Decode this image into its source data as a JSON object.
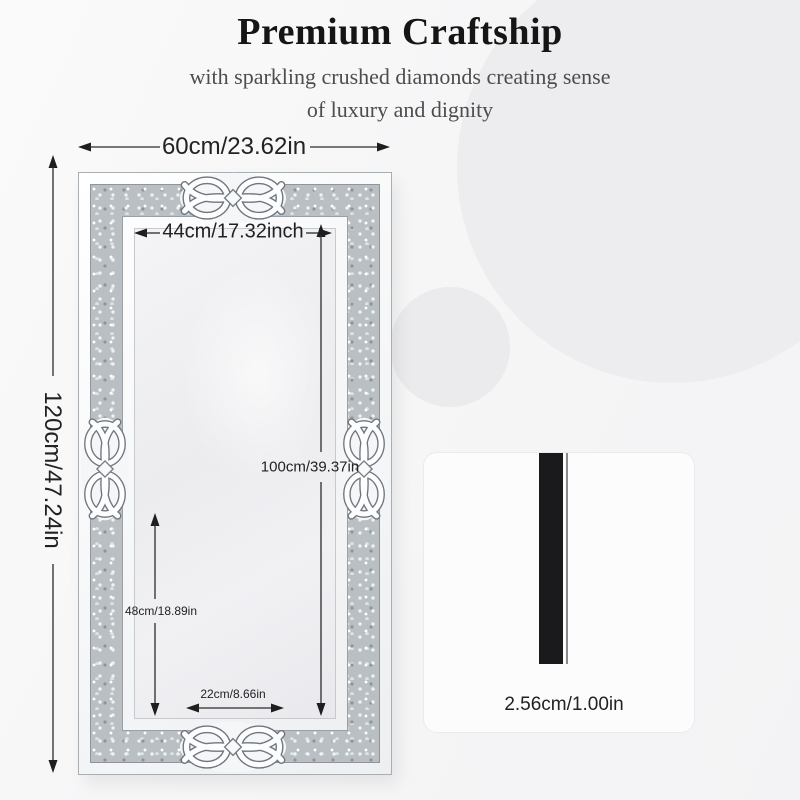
{
  "header": {
    "title": "Premium Craftship",
    "subtitle_line1": "with sparkling crushed diamonds creating sense",
    "subtitle_line2": "of luxury and dignity"
  },
  "mirror_diagram": {
    "figure": "crushed-diamond-mirror-front-view",
    "ornament": "celtic-knot-ornament",
    "dimensions": {
      "outer_width": "60cm/23.62in",
      "outer_height": "120cm/47.24in",
      "inner_width": "44cm/17.32inch",
      "inner_height": "100cm/39.37in",
      "lower_partial_height": "48cm/18.89in",
      "bottom_inner_width": "22cm/8.66in"
    }
  },
  "side_view": {
    "figure": "mirror-thickness-side-profile",
    "thickness": "2.56cm/1.00in"
  },
  "icons": {
    "knot": "celtic-knot-ornament",
    "arrow": "dimension-arrow"
  },
  "colors": {
    "background": "#f6f6f7",
    "decorative_circle": "#ededef",
    "title_text": "#151515",
    "subtitle_text": "#4d4d4d",
    "dimension_text": "#222222",
    "frame_band": "#b9bfc3",
    "side_bar": "#1a1a1d",
    "card_background": "#fcfcfd"
  }
}
